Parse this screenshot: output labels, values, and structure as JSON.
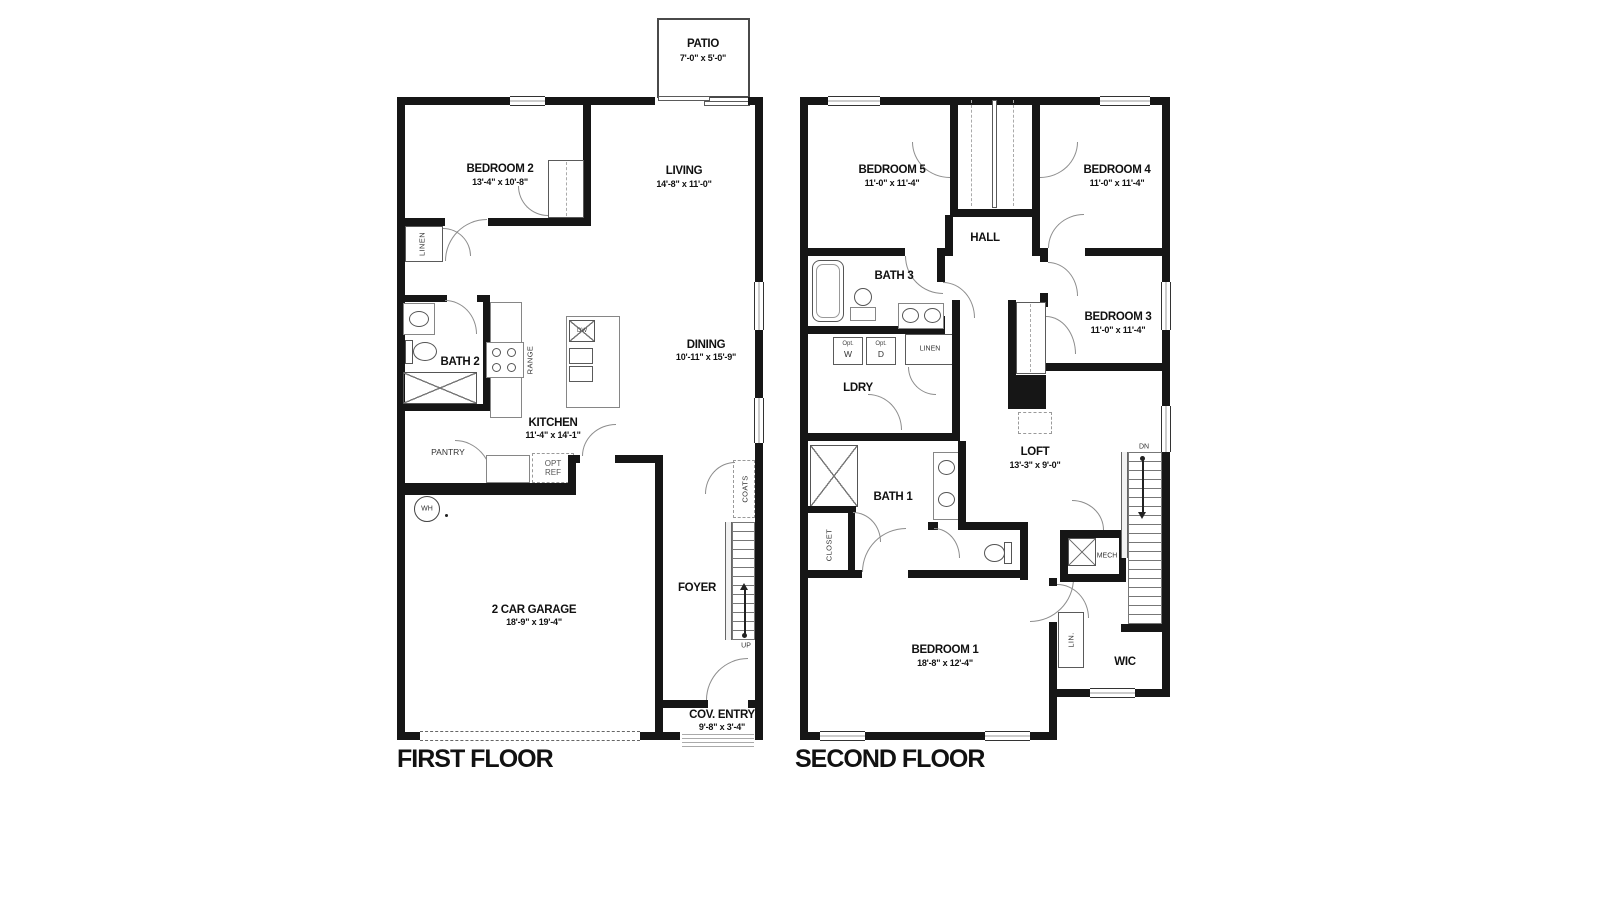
{
  "titles": {
    "first": "FIRST FLOOR",
    "second": "SECOND FLOOR"
  },
  "first_floor": {
    "patio": {
      "name": "PATIO",
      "dims": "7'-0\" x 5'-0\""
    },
    "bedroom2": {
      "name": "BEDROOM 2",
      "dims": "13'-4\" x 10'-8\""
    },
    "living": {
      "name": "LIVING",
      "dims": "14'-8\" x 11'-0\""
    },
    "dining": {
      "name": "DINING",
      "dims": "10'-11\" x 15'-9\""
    },
    "kitchen": {
      "name": "KITCHEN",
      "dims": "11'-4\" x 14'-1\""
    },
    "bath2": {
      "name": "BATH 2"
    },
    "garage": {
      "name": "2 CAR GARAGE",
      "dims": "18'-9\" x 19'-4\""
    },
    "foyer": {
      "name": "FOYER"
    },
    "cov_entry": {
      "name": "COV. ENTRY",
      "dims": "9'-8\" x 3'-4\""
    },
    "labels": {
      "linen": "LINEN",
      "range": "RANGE",
      "dw": "DW",
      "pantry": "PANTRY",
      "opt_ref": "OPT REF",
      "wh": "WH",
      "coats": "COATS",
      "up": "UP"
    }
  },
  "second_floor": {
    "bedroom5": {
      "name": "BEDROOM 5",
      "dims": "11'-0\" x 11'-4\""
    },
    "bedroom4": {
      "name": "BEDROOM 4",
      "dims": "11'-0\" x 11'-4\""
    },
    "bedroom3": {
      "name": "BEDROOM 3",
      "dims": "11'-0\" x 11'-4\""
    },
    "bedroom1": {
      "name": "BEDROOM 1",
      "dims": "18'-8\" x 12'-4\""
    },
    "hall": {
      "name": "HALL"
    },
    "bath3": {
      "name": "BATH 3"
    },
    "bath1": {
      "name": "BATH 1"
    },
    "ldry": {
      "name": "LDRY"
    },
    "loft": {
      "name": "LOFT",
      "dims": "13'-3\" x 9'-0\""
    },
    "wic": {
      "name": "WIC"
    },
    "mech": {
      "name": "MECH"
    },
    "labels": {
      "linen": "LINEN",
      "closet": "CLOSET",
      "lin": "LIN.",
      "dn": "DN",
      "opt": "Opt.",
      "w": "W",
      "d": "D"
    }
  }
}
